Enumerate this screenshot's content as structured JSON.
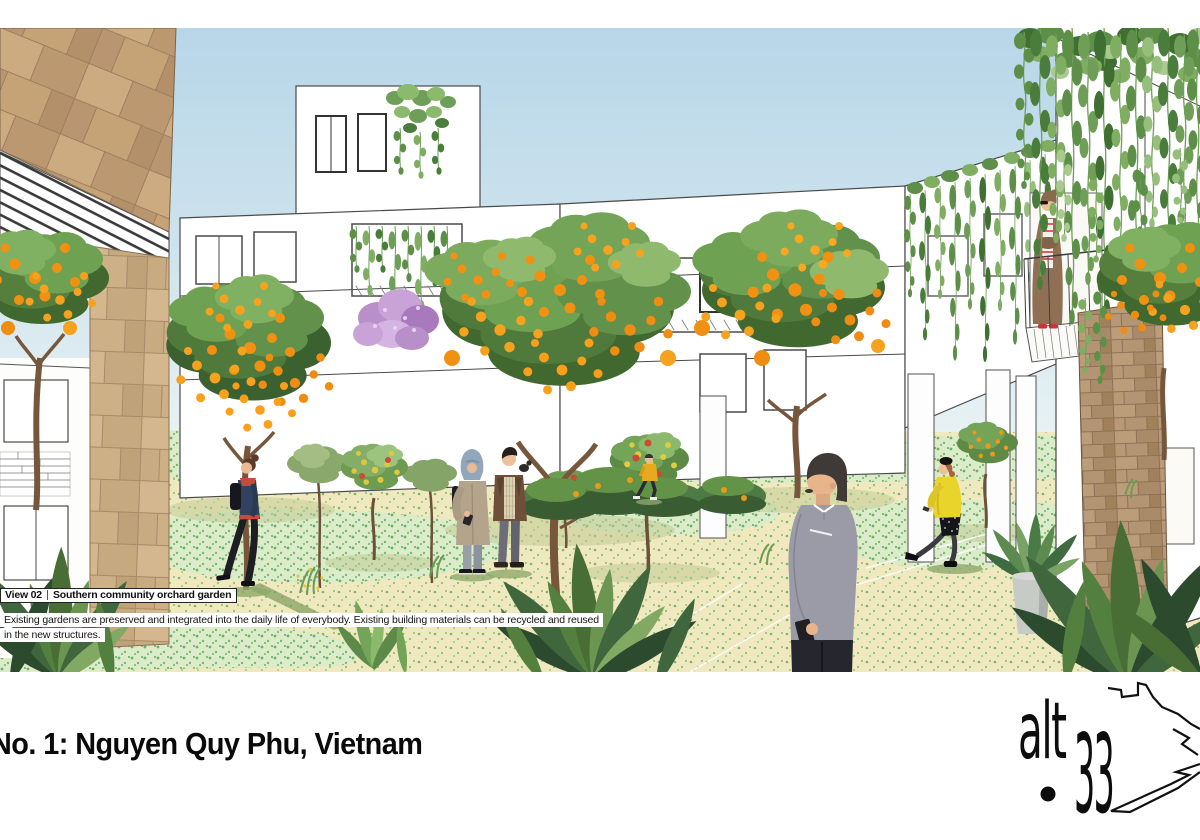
{
  "board": {
    "title": "No. 1: Nguyen Quy Phu, Vietnam"
  },
  "view_label": {
    "view_id": "View 02",
    "separator": "|",
    "name": "Southern community orchard garden"
  },
  "caption": {
    "line1": "Existing gardens are preserved and integrated into the daily life of everybody. Existing building materials can be recycled and reused",
    "line2": "in the new structures."
  },
  "logo": {
    "word": "alt",
    "number": "33"
  },
  "palette": {
    "background": "#ffffff",
    "sky_top": "#b7d6e8",
    "sky_horizon": "#eaf3f4",
    "stone_wall": "#c2a078",
    "stone_pillar_left": "#cdb086",
    "stone_pillar_right": "#b09270",
    "orange_fruit": "#f29111",
    "foliage_dark": "#3f6b34",
    "foliage_mid": "#6fa152",
    "vine_green": "#7fae62",
    "ground_cream": "#f0e8bf",
    "ground_mint": "#dcecca",
    "purple_blossom": "#c9a3d8",
    "yellow_coat": "#e9d42c",
    "red_hood": "#c34b3f",
    "text": "#111111"
  }
}
